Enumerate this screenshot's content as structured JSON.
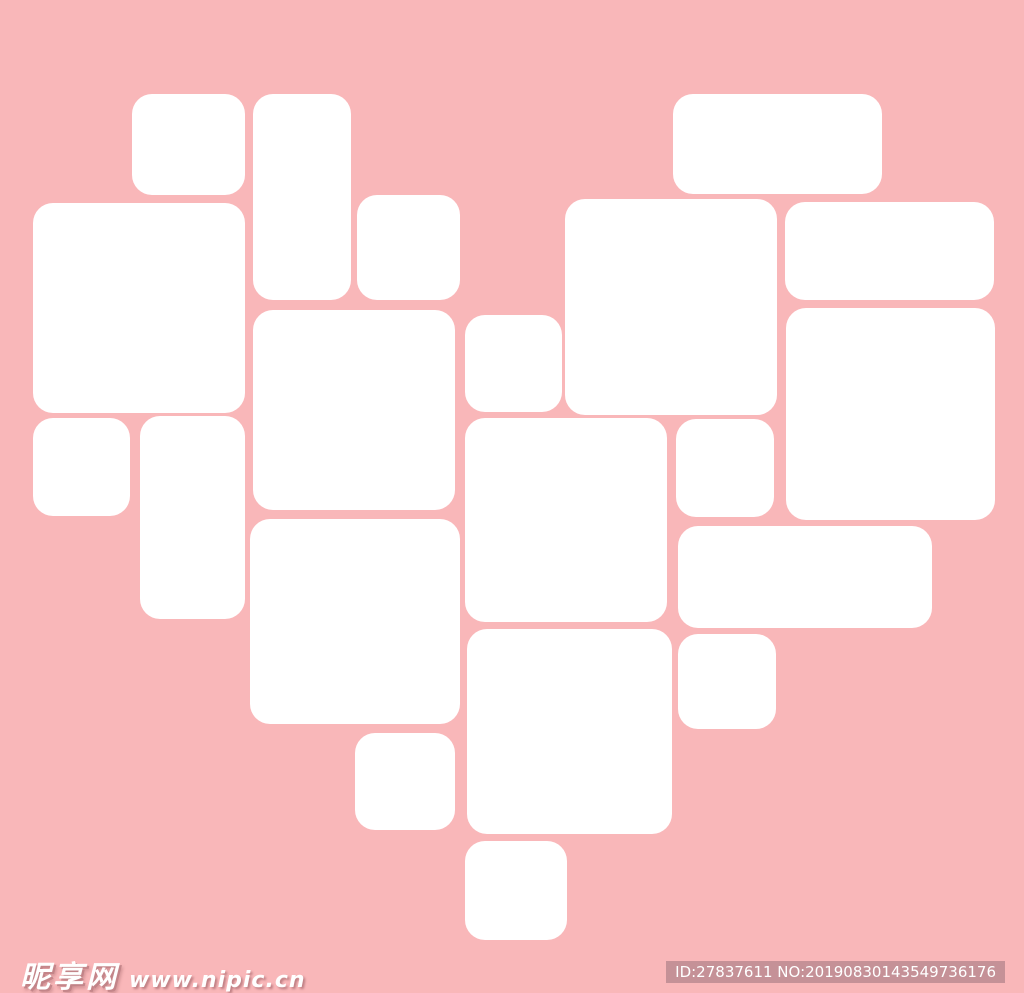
{
  "canvas": {
    "width": 1024,
    "height": 993,
    "background": "#f9b7b9",
    "tile_color": "#ffffff",
    "corner_radius": 20
  },
  "heart_collage": {
    "description": "heart-shaped arrangement of blank white photo tiles",
    "tiles": [
      {
        "x": 132,
        "y": 94,
        "w": 113,
        "h": 101
      },
      {
        "x": 253,
        "y": 94,
        "w": 98,
        "h": 206
      },
      {
        "x": 673,
        "y": 94,
        "w": 209,
        "h": 100
      },
      {
        "x": 357,
        "y": 195,
        "w": 103,
        "h": 105
      },
      {
        "x": 565,
        "y": 199,
        "w": 212,
        "h": 216
      },
      {
        "x": 785,
        "y": 202,
        "w": 209,
        "h": 98
      },
      {
        "x": 33,
        "y": 203,
        "w": 212,
        "h": 210
      },
      {
        "x": 786,
        "y": 308,
        "w": 209,
        "h": 212
      },
      {
        "x": 253,
        "y": 310,
        "w": 202,
        "h": 200
      },
      {
        "x": 465,
        "y": 315,
        "w": 97,
        "h": 97
      },
      {
        "x": 140,
        "y": 416,
        "w": 105,
        "h": 203
      },
      {
        "x": 33,
        "y": 418,
        "w": 97,
        "h": 98
      },
      {
        "x": 465,
        "y": 418,
        "w": 202,
        "h": 204
      },
      {
        "x": 676,
        "y": 419,
        "w": 98,
        "h": 98
      },
      {
        "x": 250,
        "y": 519,
        "w": 210,
        "h": 205
      },
      {
        "x": 678,
        "y": 526,
        "w": 254,
        "h": 102
      },
      {
        "x": 467,
        "y": 629,
        "w": 205,
        "h": 205
      },
      {
        "x": 678,
        "y": 634,
        "w": 98,
        "h": 95
      },
      {
        "x": 355,
        "y": 733,
        "w": 100,
        "h": 97
      },
      {
        "x": 465,
        "y": 841,
        "w": 102,
        "h": 99
      }
    ]
  },
  "watermark": {
    "site_name": "昵享网",
    "site_url": "www.nipic.cn",
    "text_color": "#ffffff"
  },
  "id_badge": {
    "text": "ID:27837611 NO:20190830143549736176",
    "background": "#c59197",
    "text_color": "#ffffff"
  }
}
